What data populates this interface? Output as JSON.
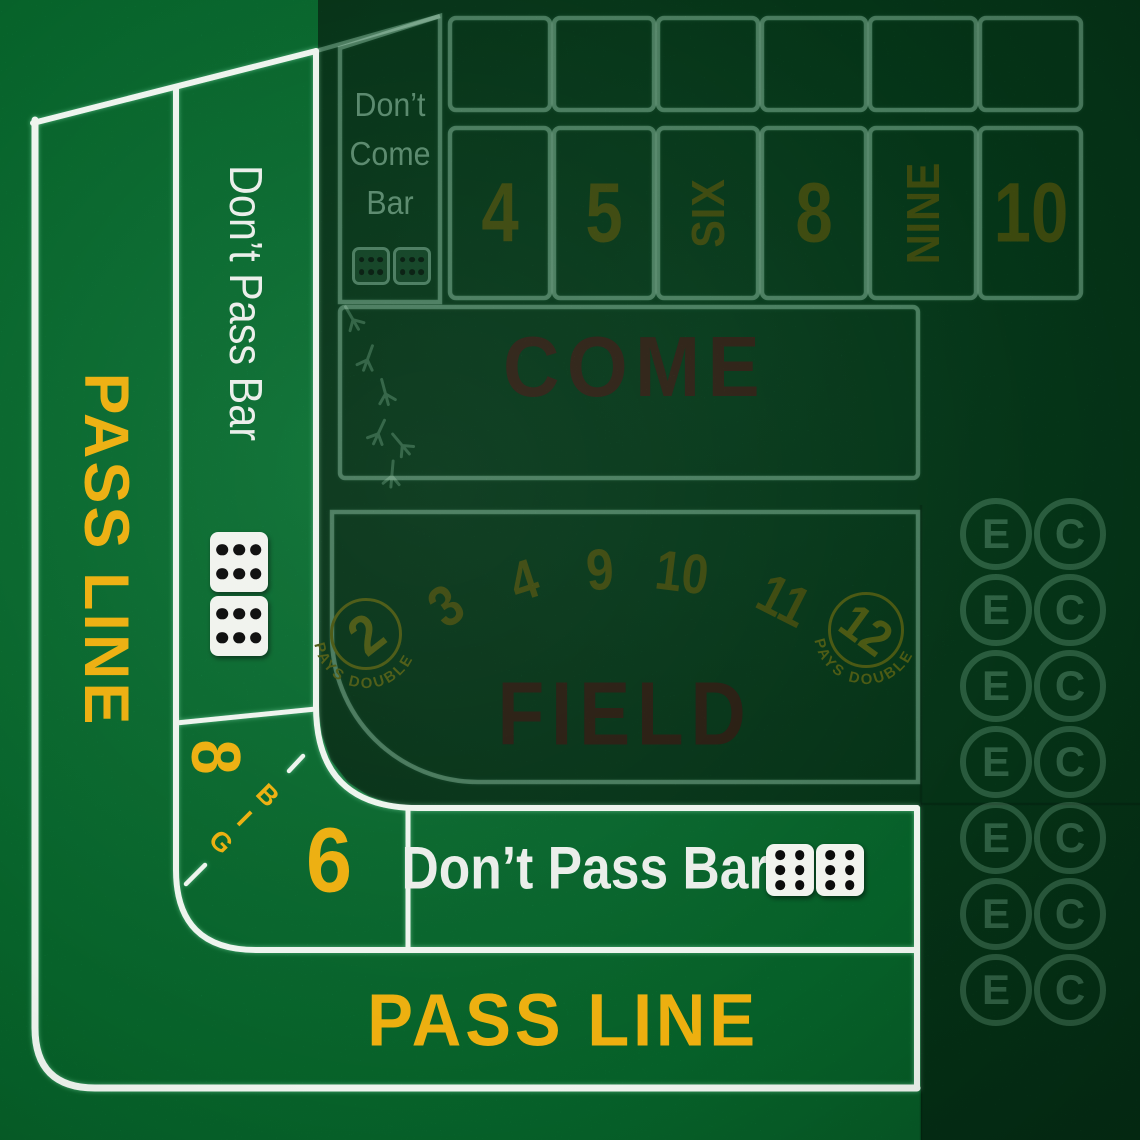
{
  "table": {
    "game": "Craps table layout",
    "colors": {
      "felt_light": "#0D8444",
      "felt_dark": "#0A4C27",
      "line_white": "#F4F8F4",
      "line_sage": "#CFE8D8",
      "accent_yellow": "#F3C71E",
      "accent_olive": "#5C6B1B",
      "accent_brown": "#4A3A27"
    }
  },
  "left_rail": {
    "pass_line_label": "PASS LINE",
    "dont_pass_label": "Don’t Pass Bar",
    "dice_icon": "two-dice-showing-six-and-six"
  },
  "dont_come": {
    "line1": "Don’t",
    "line2": "Come",
    "line3": "Bar",
    "dice_icon": "two-dice-showing-six-and-six"
  },
  "points": {
    "labels": [
      "4",
      "5",
      "SIX",
      "8",
      "NINE",
      "10"
    ]
  },
  "come": {
    "label": "COME",
    "decoration": "bird-track-icons"
  },
  "field": {
    "label": "FIELD",
    "circle_left": {
      "number": "2",
      "caption": "PAYS DOUBLE"
    },
    "numbers": [
      "3",
      "4",
      "9",
      "10",
      "11"
    ],
    "circle_right": {
      "number": "12",
      "caption": "PAYS DOUBLE"
    }
  },
  "big_corner": {
    "eight": "8",
    "letters": [
      "B",
      "I",
      "G"
    ],
    "six": "6"
  },
  "bottom_rail": {
    "dont_pass_label": "Don’t Pass Bar",
    "dice_icon": "two-dice-showing-six-and-six",
    "pass_line_label": "PASS LINE"
  },
  "proposition": {
    "eleven": "E",
    "craps": "C",
    "rows": 7
  }
}
